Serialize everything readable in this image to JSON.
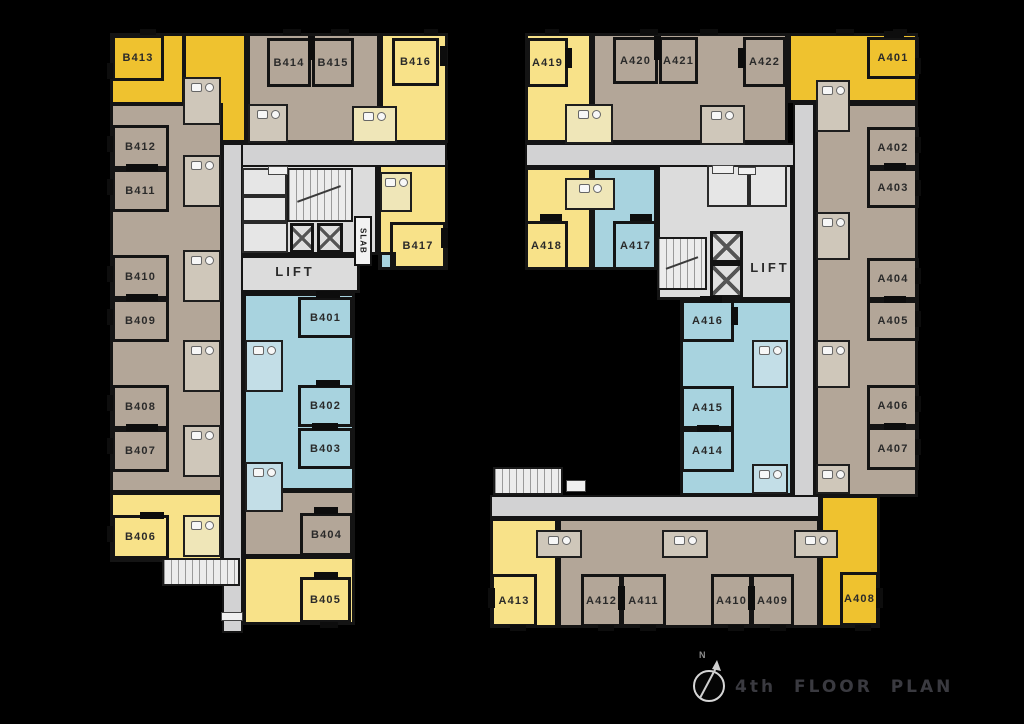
{
  "meta": {
    "floor_title": "4th FLOOR PLAN",
    "north_label": "N"
  },
  "plan": {
    "palette": {
      "gold": "#EFC22F",
      "pale": "#F8E289",
      "tan": "#B3A698",
      "blue": "#A8D3DF",
      "corridor": "#D2D2D3",
      "core": "#DCDCDC",
      "wall": "#141414",
      "bath_tan": "#CFC7BA",
      "bath_pale": "#EFE6B8",
      "bath_blue": "#C3DEE7",
      "label_text": "#2A2A2A",
      "title_text": "#3A3A40",
      "background": "#000000"
    },
    "regions": [
      {
        "id": "b413",
        "type": "gold",
        "rect": [
          110,
          33,
          75,
          72
        ]
      },
      {
        "id": "b413-entry",
        "type": "gold",
        "rect": [
          183,
          33,
          64,
          110
        ]
      },
      {
        "id": "b-top-row",
        "type": "tan",
        "rect": [
          247,
          33,
          133,
          110
        ]
      },
      {
        "id": "b416",
        "type": "pale",
        "rect": [
          380,
          33,
          68,
          110
        ]
      },
      {
        "id": "b-left-column",
        "type": "tan",
        "rect": [
          110,
          103,
          113,
          390
        ]
      },
      {
        "id": "b406",
        "type": "pale",
        "rect": [
          110,
          492,
          113,
          70
        ]
      },
      {
        "id": "b417",
        "type": "pale",
        "rect": [
          378,
          160,
          70,
          110
        ]
      },
      {
        "id": "b-blue-column",
        "type": "blue",
        "rect": [
          243,
          293,
          112,
          198
        ]
      },
      {
        "id": "b404",
        "type": "tan",
        "rect": [
          243,
          490,
          112,
          67
        ]
      },
      {
        "id": "b405",
        "type": "pale",
        "rect": [
          243,
          556,
          112,
          69
        ]
      },
      {
        "id": "b-blue-nook",
        "type": "blue",
        "rect": [
          379,
          252,
          17,
          18
        ]
      },
      {
        "id": "a419",
        "type": "pale",
        "rect": [
          525,
          33,
          67,
          110
        ]
      },
      {
        "id": "a-top-row",
        "type": "tan",
        "rect": [
          592,
          33,
          196,
          110
        ]
      },
      {
        "id": "a401-corner",
        "type": "gold",
        "rect": [
          788,
          33,
          130,
          70
        ]
      },
      {
        "id": "a-right-column",
        "type": "tan",
        "rect": [
          815,
          103,
          103,
          394
        ]
      },
      {
        "id": "a408",
        "type": "gold",
        "rect": [
          820,
          495,
          60,
          133
        ]
      },
      {
        "id": "a418",
        "type": "pale",
        "rect": [
          525,
          167,
          67,
          103
        ]
      },
      {
        "id": "a417",
        "type": "blue",
        "rect": [
          592,
          167,
          65,
          103
        ]
      },
      {
        "id": "a-blue-column",
        "type": "blue",
        "rect": [
          680,
          300,
          113,
          196
        ]
      },
      {
        "id": "a413",
        "type": "pale",
        "rect": [
          490,
          518,
          68,
          110
        ]
      },
      {
        "id": "a-bottom-row",
        "type": "tan",
        "rect": [
          558,
          518,
          262,
          110
        ]
      }
    ],
    "cores": [
      {
        "id": "b-core",
        "rect": [
          240,
          163,
          138,
          92
        ]
      },
      {
        "id": "b-lift-lobby",
        "rect": [
          240,
          255,
          120,
          38
        ]
      },
      {
        "id": "a-core",
        "rect": [
          657,
          163,
          136,
          137
        ]
      }
    ],
    "corridors": [
      {
        "id": "b-corridor-h",
        "rect": [
          222,
          143,
          225,
          24
        ]
      },
      {
        "id": "b-corridor-v",
        "rect": [
          222,
          143,
          21,
          490
        ]
      },
      {
        "id": "a-corridor-h",
        "rect": [
          525,
          143,
          270,
          24
        ]
      },
      {
        "id": "a-corridor-v",
        "rect": [
          793,
          103,
          22,
          415
        ]
      },
      {
        "id": "a-corridor-bottom",
        "rect": [
          490,
          495,
          330,
          23
        ]
      }
    ],
    "junction_patches": [
      [
        224,
        145,
        17,
        20
      ],
      [
        795,
        145,
        18,
        20
      ],
      [
        795,
        497,
        18,
        19
      ]
    ],
    "stairs": [
      {
        "id": "b-main",
        "rect": [
          287,
          168,
          66,
          54
        ],
        "arrow": true
      },
      {
        "id": "b-south",
        "rect": [
          162,
          558,
          78,
          28
        ],
        "arrow": false
      },
      {
        "id": "a-core",
        "rect": [
          657,
          237,
          50,
          53
        ],
        "arrow": true
      },
      {
        "id": "a-south",
        "rect": [
          493,
          467,
          70,
          28
        ],
        "arrow": false
      }
    ],
    "lifts": [
      [
        290,
        223,
        24,
        30
      ],
      [
        317,
        223,
        26,
        30
      ],
      [
        710,
        231,
        33,
        32
      ],
      [
        710,
        263,
        33,
        35
      ]
    ],
    "cells": [
      [
        242,
        168,
        45,
        28
      ],
      [
        242,
        196,
        45,
        26
      ],
      [
        242,
        222,
        46,
        31
      ],
      [
        707,
        165,
        42,
        42
      ],
      [
        749,
        165,
        38,
        42
      ]
    ],
    "bathrooms": [
      {
        "rect": [
          183,
          77,
          38,
          48
        ],
        "tint": "bath_tan"
      },
      {
        "rect": [
          183,
          155,
          38,
          52
        ],
        "tint": "bath_tan"
      },
      {
        "rect": [
          183,
          250,
          38,
          52
        ],
        "tint": "bath_tan"
      },
      {
        "rect": [
          183,
          340,
          38,
          52
        ],
        "tint": "bath_tan"
      },
      {
        "rect": [
          183,
          425,
          38,
          52
        ],
        "tint": "bath_tan"
      },
      {
        "rect": [
          183,
          515,
          38,
          42
        ],
        "tint": "bath_pale"
      },
      {
        "rect": [
          248,
          104,
          40,
          39
        ],
        "tint": "bath_tan"
      },
      {
        "rect": [
          352,
          106,
          45,
          37
        ],
        "tint": "bath_pale"
      },
      {
        "rect": [
          380,
          172,
          32,
          40
        ],
        "tint": "bath_pale"
      },
      {
        "rect": [
          245,
          340,
          38,
          52
        ],
        "tint": "bath_blue"
      },
      {
        "rect": [
          245,
          462,
          38,
          50
        ],
        "tint": "bath_blue"
      },
      {
        "rect": [
          565,
          104,
          48,
          40
        ],
        "tint": "bath_pale"
      },
      {
        "rect": [
          700,
          105,
          45,
          40
        ],
        "tint": "bath_tan"
      },
      {
        "rect": [
          565,
          178,
          50,
          32
        ],
        "tint": "bath_pale"
      },
      {
        "rect": [
          816,
          80,
          34,
          52
        ],
        "tint": "bath_tan"
      },
      {
        "rect": [
          816,
          212,
          34,
          48
        ],
        "tint": "bath_tan"
      },
      {
        "rect": [
          816,
          340,
          34,
          48
        ],
        "tint": "bath_tan"
      },
      {
        "rect": [
          816,
          464,
          34,
          30
        ],
        "tint": "bath_tan"
      },
      {
        "rect": [
          752,
          340,
          36,
          48
        ],
        "tint": "bath_blue"
      },
      {
        "rect": [
          752,
          464,
          36,
          30
        ],
        "tint": "bath_blue"
      },
      {
        "rect": [
          536,
          530,
          46,
          28
        ],
        "tint": "bath_tan"
      },
      {
        "rect": [
          662,
          530,
          46,
          28
        ],
        "tint": "bath_tan"
      },
      {
        "rect": [
          794,
          530,
          44,
          28
        ],
        "tint": "bath_tan"
      }
    ],
    "rooms": [
      {
        "unit": "B413",
        "rect": [
          112,
          35,
          52,
          46
        ]
      },
      {
        "unit": "B412",
        "rect": [
          112,
          125,
          57,
          44
        ]
      },
      {
        "unit": "B411",
        "rect": [
          112,
          169,
          57,
          43
        ]
      },
      {
        "unit": "B410",
        "rect": [
          112,
          255,
          57,
          44
        ]
      },
      {
        "unit": "B409",
        "rect": [
          112,
          299,
          57,
          43
        ]
      },
      {
        "unit": "B408",
        "rect": [
          112,
          385,
          57,
          44
        ]
      },
      {
        "unit": "B407",
        "rect": [
          112,
          429,
          57,
          43
        ]
      },
      {
        "unit": "B406",
        "rect": [
          112,
          515,
          57,
          44
        ]
      },
      {
        "unit": "B414",
        "rect": [
          267,
          38,
          44,
          49
        ]
      },
      {
        "unit": "B415",
        "rect": [
          312,
          38,
          42,
          49
        ]
      },
      {
        "unit": "B416",
        "rect": [
          392,
          38,
          47,
          48
        ]
      },
      {
        "unit": "B417",
        "rect": [
          390,
          222,
          56,
          47
        ]
      },
      {
        "unit": "B401",
        "rect": [
          298,
          297,
          55,
          41
        ]
      },
      {
        "unit": "B402",
        "rect": [
          298,
          385,
          55,
          42
        ]
      },
      {
        "unit": "B403",
        "rect": [
          298,
          428,
          55,
          41
        ]
      },
      {
        "unit": "B404",
        "rect": [
          300,
          513,
          53,
          43
        ]
      },
      {
        "unit": "B405",
        "rect": [
          300,
          577,
          51,
          46
        ]
      },
      {
        "unit": "A419",
        "rect": [
          527,
          38,
          41,
          49
        ]
      },
      {
        "unit": "A420",
        "rect": [
          613,
          37,
          45,
          47
        ]
      },
      {
        "unit": "A421",
        "rect": [
          659,
          37,
          39,
          47
        ]
      },
      {
        "unit": "A422",
        "rect": [
          743,
          37,
          43,
          50
        ]
      },
      {
        "unit": "A401",
        "rect": [
          867,
          37,
          52,
          42
        ]
      },
      {
        "unit": "A402",
        "rect": [
          867,
          127,
          52,
          41
        ]
      },
      {
        "unit": "A403",
        "rect": [
          867,
          168,
          52,
          40
        ]
      },
      {
        "unit": "A404",
        "rect": [
          867,
          258,
          52,
          42
        ]
      },
      {
        "unit": "A405",
        "rect": [
          867,
          300,
          52,
          41
        ]
      },
      {
        "unit": "A406",
        "rect": [
          867,
          385,
          52,
          42
        ]
      },
      {
        "unit": "A407",
        "rect": [
          867,
          427,
          52,
          43
        ]
      },
      {
        "unit": "A418",
        "rect": [
          525,
          221,
          43,
          49
        ]
      },
      {
        "unit": "A417",
        "rect": [
          613,
          221,
          45,
          49
        ]
      },
      {
        "unit": "A416",
        "rect": [
          681,
          300,
          53,
          42
        ]
      },
      {
        "unit": "A415",
        "rect": [
          681,
          386,
          53,
          43
        ]
      },
      {
        "unit": "A414",
        "rect": [
          681,
          429,
          53,
          43
        ]
      },
      {
        "unit": "A413",
        "rect": [
          491,
          574,
          46,
          53
        ]
      },
      {
        "unit": "A412",
        "rect": [
          581,
          574,
          41,
          53
        ]
      },
      {
        "unit": "A411",
        "rect": [
          621,
          574,
          45,
          53
        ]
      },
      {
        "unit": "A410",
        "rect": [
          711,
          574,
          41,
          53
        ]
      },
      {
        "unit": "A409",
        "rect": [
          751,
          574,
          43,
          53
        ]
      },
      {
        "unit": "A408",
        "rect": [
          840,
          572,
          39,
          54
        ]
      }
    ],
    "marks": [
      [
        126,
        164,
        32,
        7
      ],
      [
        126,
        294,
        32,
        7
      ],
      [
        126,
        424,
        32,
        7
      ],
      [
        140,
        512,
        24,
        7
      ],
      [
        308,
        36,
        7,
        24
      ],
      [
        440,
        46,
        7,
        20
      ],
      [
        441,
        228,
        7,
        20
      ],
      [
        316,
        291,
        24,
        7
      ],
      [
        316,
        380,
        24,
        7
      ],
      [
        312,
        423,
        26,
        7
      ],
      [
        314,
        507,
        24,
        7
      ],
      [
        314,
        572,
        24,
        7
      ],
      [
        565,
        48,
        7,
        20
      ],
      [
        654,
        36,
        7,
        24
      ],
      [
        738,
        48,
        7,
        20
      ],
      [
        884,
        31,
        20,
        7
      ],
      [
        884,
        163,
        22,
        7
      ],
      [
        884,
        296,
        22,
        7
      ],
      [
        884,
        423,
        22,
        7
      ],
      [
        540,
        214,
        22,
        7
      ],
      [
        630,
        214,
        22,
        7
      ],
      [
        700,
        296,
        22,
        7
      ],
      [
        731,
        307,
        7,
        18
      ],
      [
        697,
        425,
        22,
        7
      ],
      [
        488,
        588,
        7,
        20
      ],
      [
        618,
        586,
        7,
        24
      ],
      [
        748,
        586,
        7,
        24
      ],
      [
        876,
        588,
        7,
        20
      ],
      [
        140,
        29,
        16,
        6
      ],
      [
        283,
        29,
        18,
        6
      ],
      [
        331,
        29,
        18,
        6
      ],
      [
        424,
        29,
        14,
        6
      ],
      [
        545,
        29,
        14,
        6
      ],
      [
        640,
        29,
        18,
        6
      ],
      [
        700,
        29,
        18,
        6
      ],
      [
        836,
        29,
        18,
        6
      ],
      [
        893,
        29,
        14,
        6
      ],
      [
        107,
        63,
        6,
        16
      ],
      [
        107,
        136,
        6,
        16
      ],
      [
        107,
        179,
        6,
        16
      ],
      [
        107,
        266,
        6,
        16
      ],
      [
        107,
        309,
        6,
        16
      ],
      [
        107,
        395,
        6,
        16
      ],
      [
        107,
        438,
        6,
        16
      ],
      [
        107,
        526,
        6,
        16
      ],
      [
        915,
        58,
        6,
        16
      ],
      [
        915,
        137,
        6,
        16
      ],
      [
        915,
        180,
        6,
        16
      ],
      [
        915,
        268,
        6,
        16
      ],
      [
        915,
        311,
        6,
        16
      ],
      [
        915,
        396,
        6,
        16
      ],
      [
        915,
        439,
        6,
        16
      ],
      [
        320,
        622,
        18,
        6
      ],
      [
        510,
        625,
        16,
        6
      ],
      [
        598,
        625,
        16,
        6
      ],
      [
        640,
        625,
        16,
        6
      ],
      [
        728,
        625,
        16,
        6
      ],
      [
        770,
        625,
        16,
        6
      ],
      [
        855,
        625,
        16,
        6
      ]
    ],
    "chips": [
      [
        268,
        166,
        20,
        9
      ],
      [
        712,
        165,
        22,
        9
      ],
      [
        738,
        167,
        18,
        8
      ],
      [
        566,
        480,
        20,
        12
      ],
      [
        221,
        612,
        22,
        9
      ]
    ],
    "corridor_labels": [
      {
        "text": "LIFT",
        "rect": [
          240,
          258,
          110,
          26
        ]
      },
      {
        "text": "LIFT",
        "rect": [
          744,
          254,
          52,
          26
        ]
      }
    ],
    "slab": {
      "text": "SLAB",
      "rect": [
        354,
        216,
        18,
        50
      ]
    }
  }
}
